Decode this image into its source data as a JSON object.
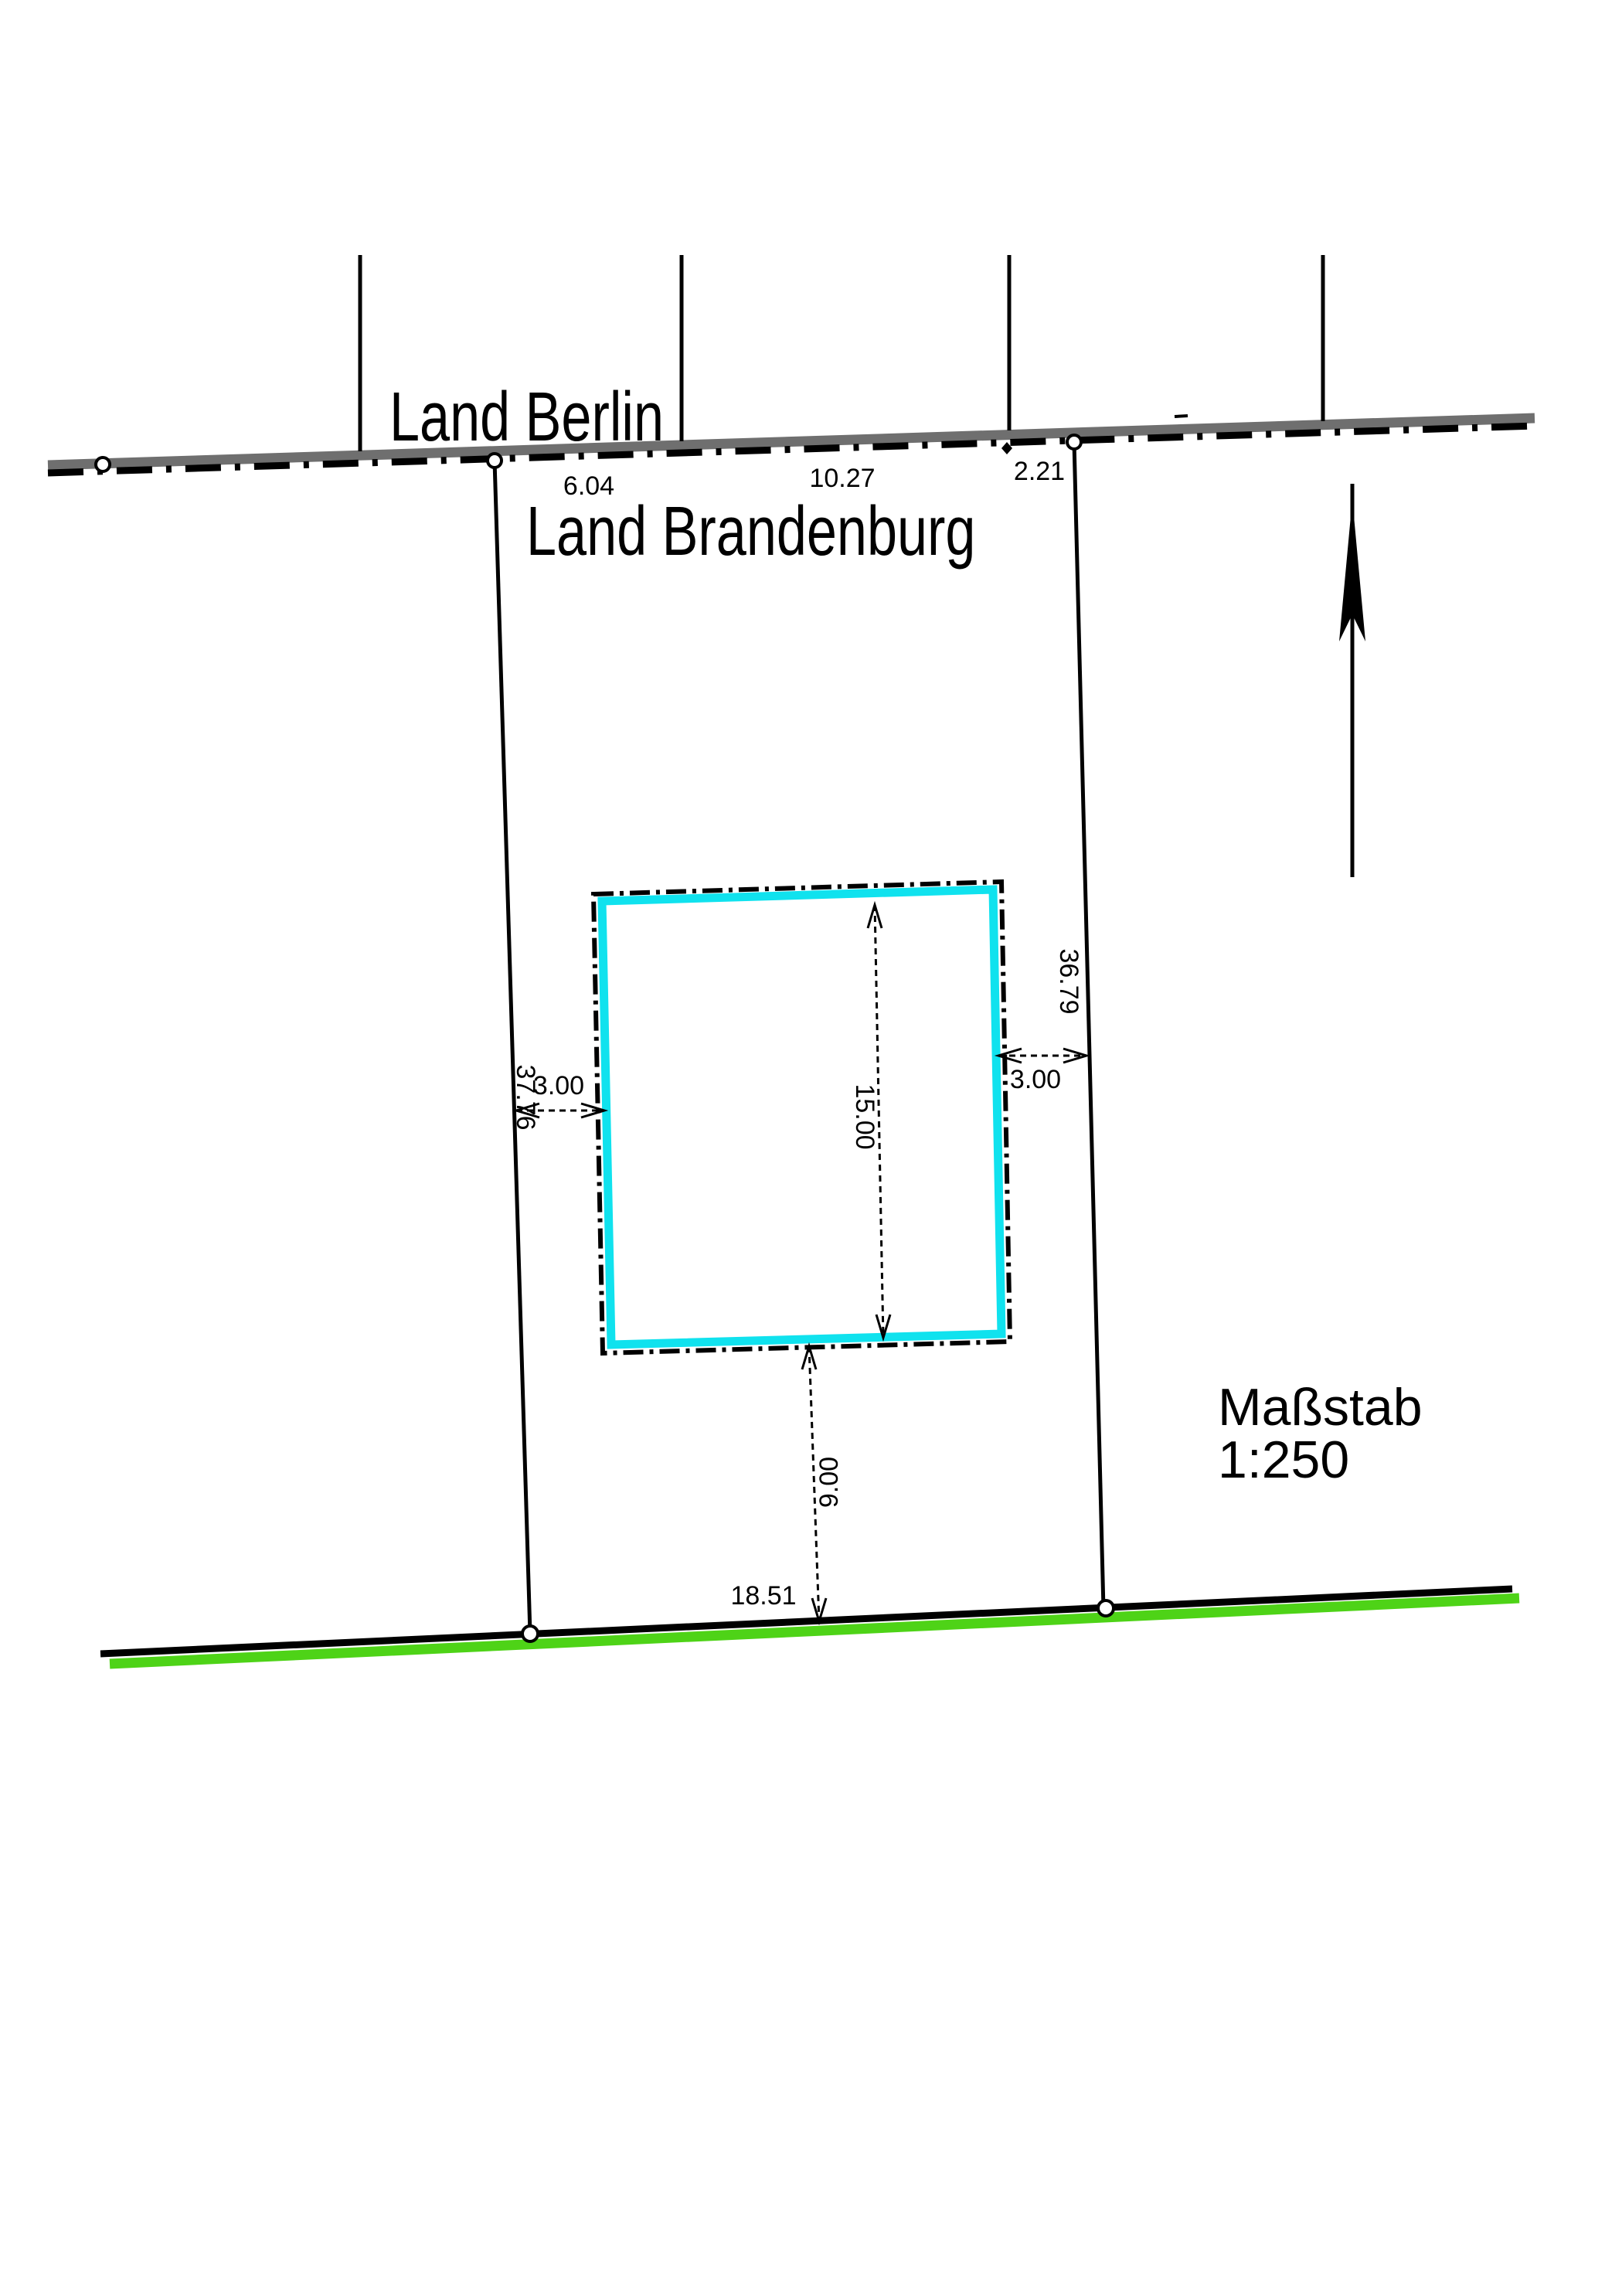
{
  "drawing": {
    "regions": {
      "above_boundary": "Land Berlin",
      "below_boundary": "Land Brandenburg"
    },
    "state_boundary": {
      "segment_lengths": [
        "6.04",
        "10.27",
        "2.21"
      ]
    },
    "parcel": {
      "left_side_length": "37.76",
      "right_side_length": "36.79",
      "street_frontage": "18.51"
    },
    "building": {
      "setback_left": "3.00",
      "setback_right": "3.00",
      "depth": "15.00",
      "setback_rear": "9.00"
    },
    "scale": {
      "label": "Maßstab",
      "value": "1:250"
    },
    "colors": {
      "building_outline": "#10e2ee",
      "street_edge_green": "#4ed317",
      "boundary_gray": "#6f6f6f",
      "ink": "#000000",
      "paper": "#ffffff"
    }
  }
}
